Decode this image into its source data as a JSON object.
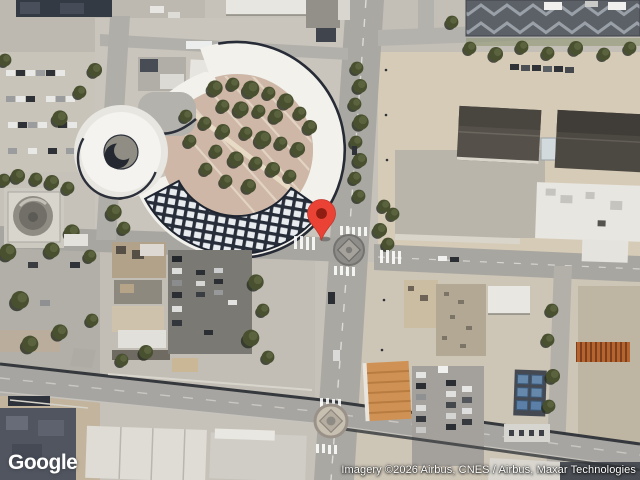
{
  "map": {
    "view_type": "satellite",
    "marker": {
      "name": "location-pin",
      "fill": "#EA4335",
      "stroke": "#B3271E",
      "dot": "#8F1D12"
    }
  },
  "footer": {
    "logo_text": "Google",
    "attribution": "Imagery ©2026 Airbus, CNES / Airbus, Maxar Technologies"
  }
}
